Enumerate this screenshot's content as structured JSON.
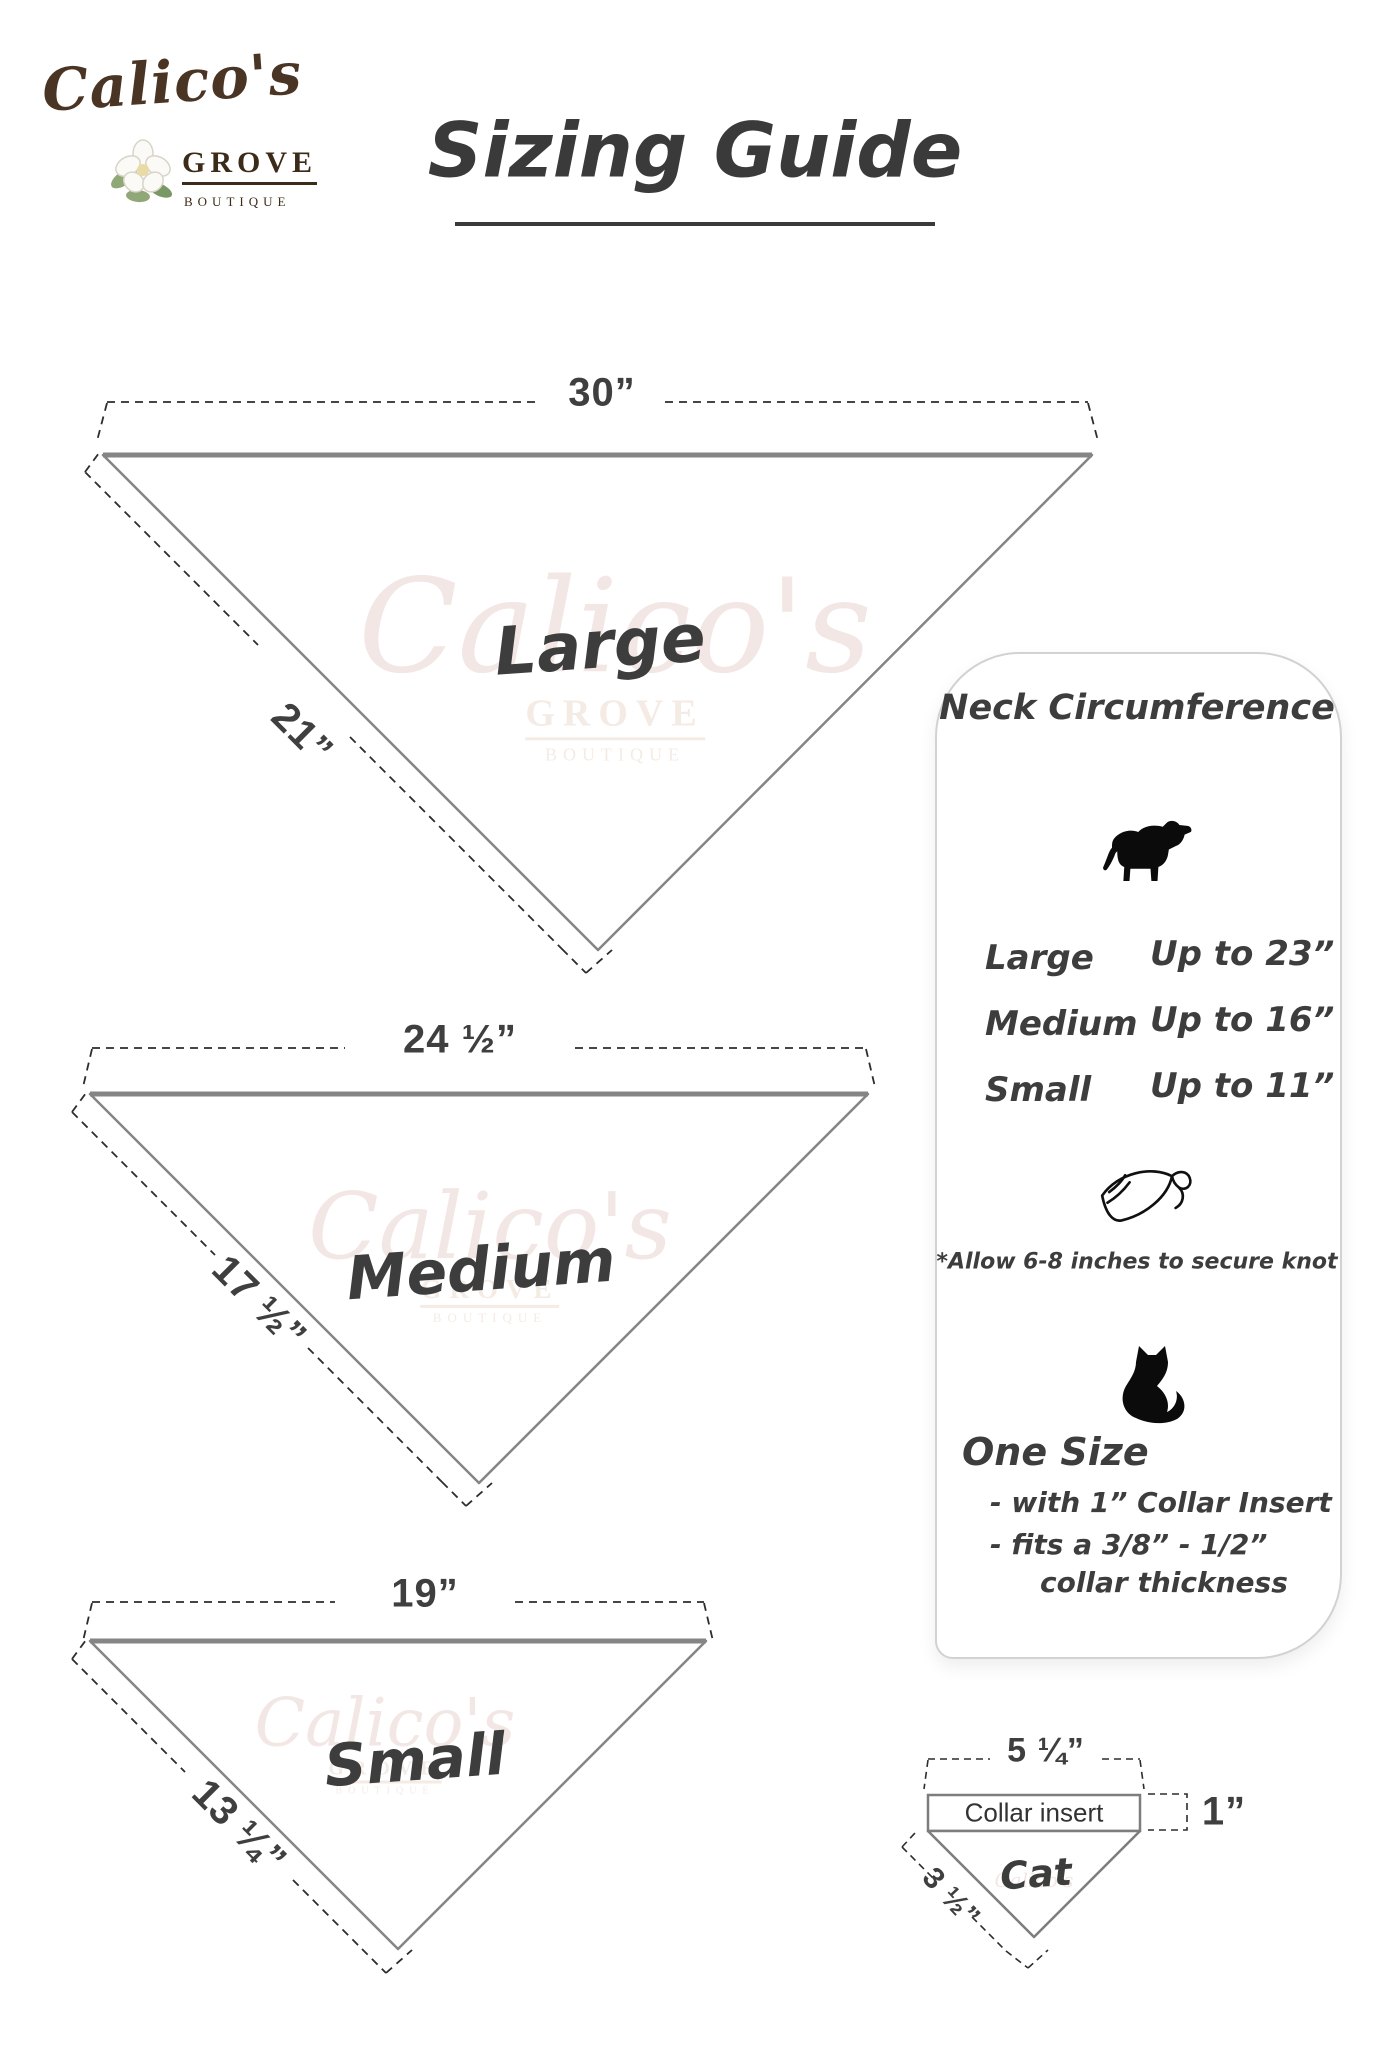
{
  "logo": {
    "brand": "Calico's",
    "grove": "GROVE",
    "boutique": "BOUTIQUE",
    "flower_icon": "magnolia-flower",
    "brand_color": "#4a3424"
  },
  "title": "Sizing Guide",
  "watermark": {
    "script": "Calico's",
    "grove": "GROVE",
    "boutique": "BOUTIQUE"
  },
  "bandanas": [
    {
      "label": "Large",
      "top_width": "30”",
      "side_length": "21”"
    },
    {
      "label": "Medium",
      "top_width": "24 ½”",
      "side_length": "17 ½”"
    },
    {
      "label": "Small",
      "top_width": "19”",
      "side_length": "13 ¼”"
    }
  ],
  "info_panel": {
    "title": "Neck Circumference",
    "dog_icon": "dog-silhouette",
    "rows": [
      {
        "size": "Large",
        "value": "Up to 23”"
      },
      {
        "size": "Medium",
        "value": "Up to 16”"
      },
      {
        "size": "Small",
        "value": "Up to 11”"
      }
    ],
    "bandana_icon": "tied-bandana",
    "knot_note": "*Allow 6-8 inches to secure knot",
    "cat_icon": "cat-silhouette",
    "one_size_heading": "One Size",
    "one_size_line1": "- with 1” Collar Insert",
    "one_size_line2": "- fits a 3/8” - 1/2”",
    "one_size_line3": "collar thickness"
  },
  "cat_diagram": {
    "label": "Cat",
    "collar_label": "Collar insert",
    "top_width": "5 ¼”",
    "insert_height": "1”",
    "side_length": "3 ½”"
  },
  "colors": {
    "outline_gray": "#858585",
    "dash_dark": "#2d2d2d",
    "text_dark": "#3d3d3d",
    "logo_brown": "#4a3424",
    "watermark_pink": "#f2e7e4"
  }
}
